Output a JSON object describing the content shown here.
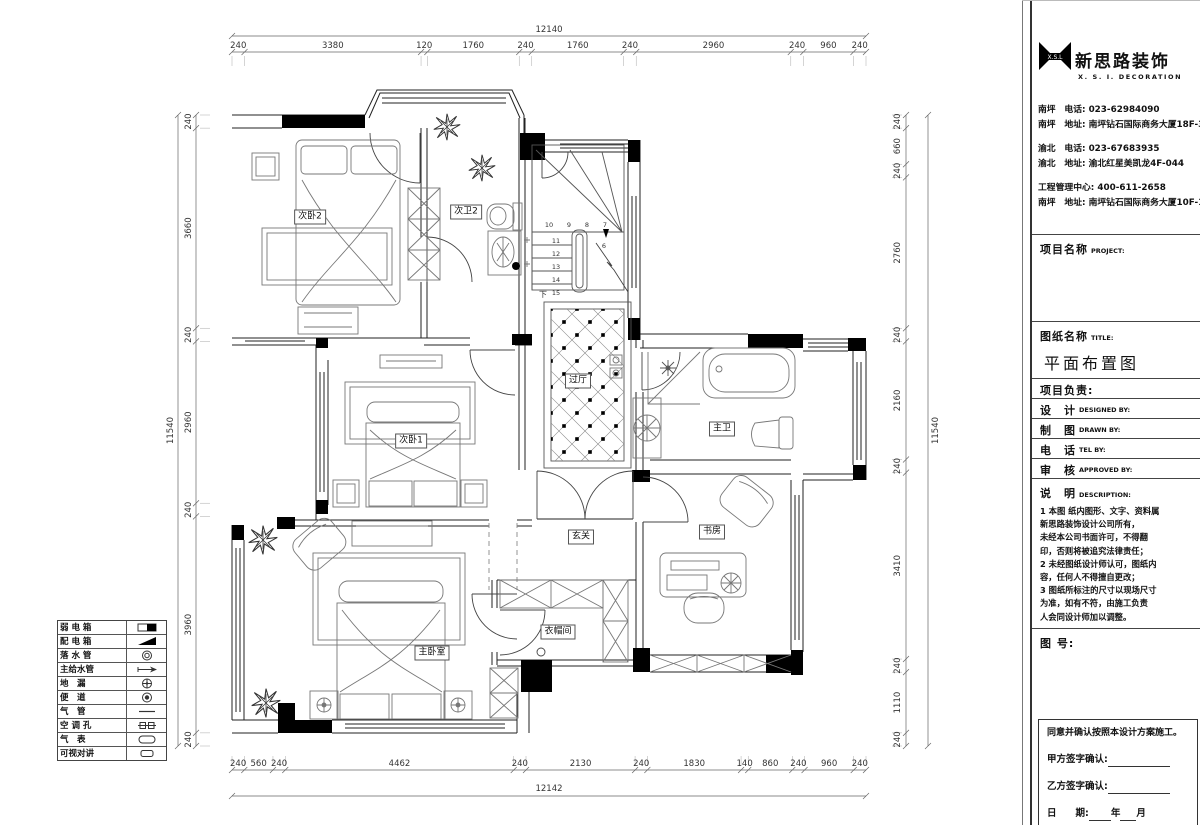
{
  "plan": {
    "rooms": [
      {
        "id": "bedroom2",
        "label": "次卧2"
      },
      {
        "id": "bath2",
        "label": "次卫2"
      },
      {
        "id": "hallway",
        "label": "过厅"
      },
      {
        "id": "bedroom1",
        "label": "次卧1"
      },
      {
        "id": "master-bedroom",
        "label": "主卧室"
      },
      {
        "id": "entry",
        "label": "玄关"
      },
      {
        "id": "cloakroom",
        "label": "衣帽间"
      },
      {
        "id": "master-bath",
        "label": "主卫"
      },
      {
        "id": "study",
        "label": "书房"
      }
    ],
    "stairs": {
      "top_row": [
        "10",
        "9",
        "8",
        "7"
      ],
      "left_col": [
        "11",
        "12",
        "13",
        "14",
        "15"
      ],
      "landing": "6",
      "down_label": "下"
    },
    "dimensions": {
      "top": {
        "total": "12140",
        "segments": [
          240,
          3380,
          120,
          1760,
          240,
          1760,
          240,
          2960,
          240,
          960,
          240
        ]
      },
      "bottom": {
        "total": "12142",
        "segments": [
          240,
          560,
          240,
          4462,
          240,
          2130,
          240,
          1830,
          140,
          860,
          240,
          960,
          240
        ]
      },
      "left": {
        "total": "11540",
        "segments": [
          240,
          3660,
          240,
          2960,
          240,
          3960,
          240
        ]
      },
      "right": {
        "total": "11540",
        "segments": [
          240,
          660,
          240,
          2760,
          240,
          2160,
          240,
          3410,
          240,
          1110,
          240
        ]
      }
    }
  },
  "legend": {
    "items": [
      {
        "name": "弱 电 箱",
        "symbol": "weak-power-box"
      },
      {
        "name": "配 电 箱",
        "symbol": "distribution-box"
      },
      {
        "name": "落 水 管",
        "symbol": "downpipe"
      },
      {
        "name": "主给水管",
        "symbol": "main-water-pipe"
      },
      {
        "name": "地　漏",
        "symbol": "floor-drain"
      },
      {
        "name": "便　道",
        "symbol": "toilet-drain"
      },
      {
        "name": "气　管",
        "symbol": "gas-pipe"
      },
      {
        "name": "空 调 孔",
        "symbol": "ac-hole"
      },
      {
        "name": "气　表",
        "symbol": "gas-meter"
      },
      {
        "name": "可视对讲",
        "symbol": "video-intercom"
      }
    ]
  },
  "title_block": {
    "logo": {
      "name": "新思路装饰",
      "subtitle": "X. S. I. DECORATION",
      "mark": "X.S.L"
    },
    "contacts": [
      "南坪　电话: 023-62984090",
      "南坪　地址: 南坪钻石国际商务大厦18F-3",
      "渝北　电话: 023-67683935",
      "渝北　地址: 渝北红星美凯龙4F-044",
      "工程管理中心: 400-611-2658",
      "南坪　地址: 南坪钻石国际商务大厦10F-1"
    ],
    "project_label": "项目名称",
    "project_en": "PROJECT:",
    "drawing_label": "图纸名称",
    "drawing_en": "TITLE:",
    "drawing_title": "平面布置图",
    "leader_label": "项目负责:",
    "design_label": "设　计",
    "design_en": "DESIGNED BY:",
    "draft_label": "制　图",
    "draft_en": "DRAWN BY:",
    "tel_label": "电　话",
    "tel_en": "TEL BY:",
    "approve_label": "审　核",
    "approve_en": "APPROVED BY:",
    "desc_label": "说　明",
    "desc_en": "DESCRIPTION:",
    "desc_lines": [
      "1 本图 纸内图形、文字、资料属",
      "   新思路装饰设计公司所有，",
      "   未经本公司书面许可，不得翻",
      "   印，否则将被追究法律责任；",
      "2 未经图纸设计师认可，图纸内",
      "   容，任何人不得擅自更改；",
      "3 图纸所标注的尺寸以现场尺寸",
      "   为准，如有不符，由施工负责",
      "   人会同设计师加以调整。"
    ],
    "figure_label": "图 号:",
    "signature": {
      "agree": "同意并确认按照本设计方案施工。",
      "party_a": "甲方签字确认:",
      "party_b": "乙方签字确认:",
      "date_label": "日　　期:",
      "year": "年",
      "month": "月"
    }
  }
}
